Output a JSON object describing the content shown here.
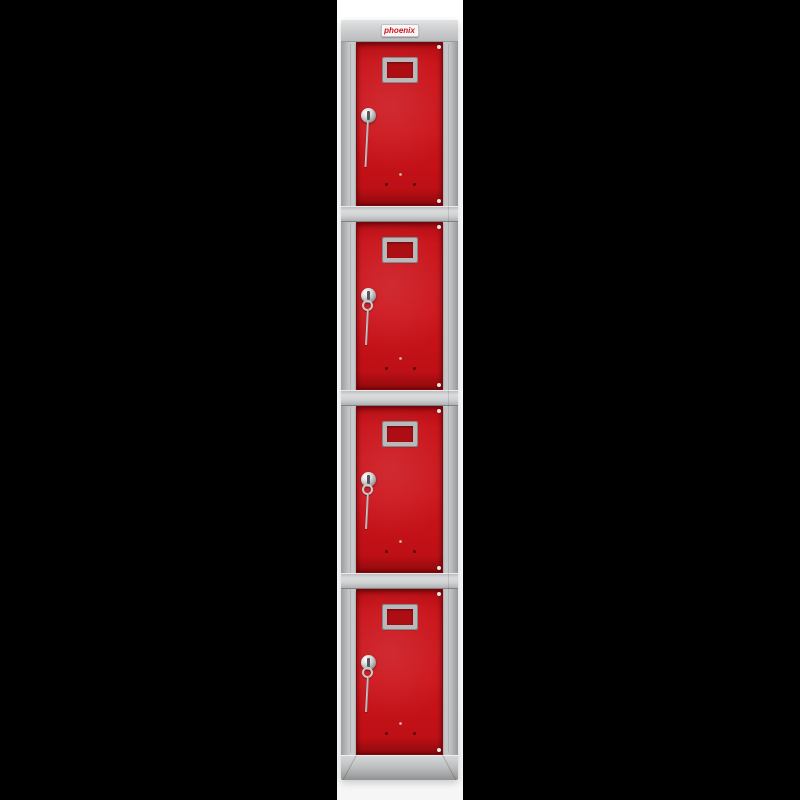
{
  "image": {
    "kind": "product-photo",
    "subject": "Tall grey steel storage locker with four red doors on a white backdrop between black side bars"
  },
  "brand": {
    "label": "phoenix",
    "logo_color": "#cf1620",
    "badge_background": "#f6f6f6"
  },
  "locker": {
    "compartments": 4,
    "frame_color": "#c9cbcd",
    "door_color": "#c6121a",
    "backdrop_color": "#ffffff",
    "side_bar_color": "#000000",
    "doors": [
      {
        "id": 1,
        "features": [
          "label-holder",
          "cam-lock",
          "hanging-key",
          "vent-holes",
          "hinge-pins"
        ]
      },
      {
        "id": 2,
        "features": [
          "label-holder",
          "cam-lock",
          "key-ring",
          "hanging-key",
          "vent-holes",
          "hinge-pins"
        ]
      },
      {
        "id": 3,
        "features": [
          "label-holder",
          "cam-lock",
          "key-ring",
          "hanging-key",
          "vent-holes",
          "hinge-pins"
        ]
      },
      {
        "id": 4,
        "features": [
          "label-holder",
          "cam-lock",
          "key-ring",
          "hanging-key",
          "vent-holes",
          "hinge-pins"
        ]
      }
    ]
  }
}
